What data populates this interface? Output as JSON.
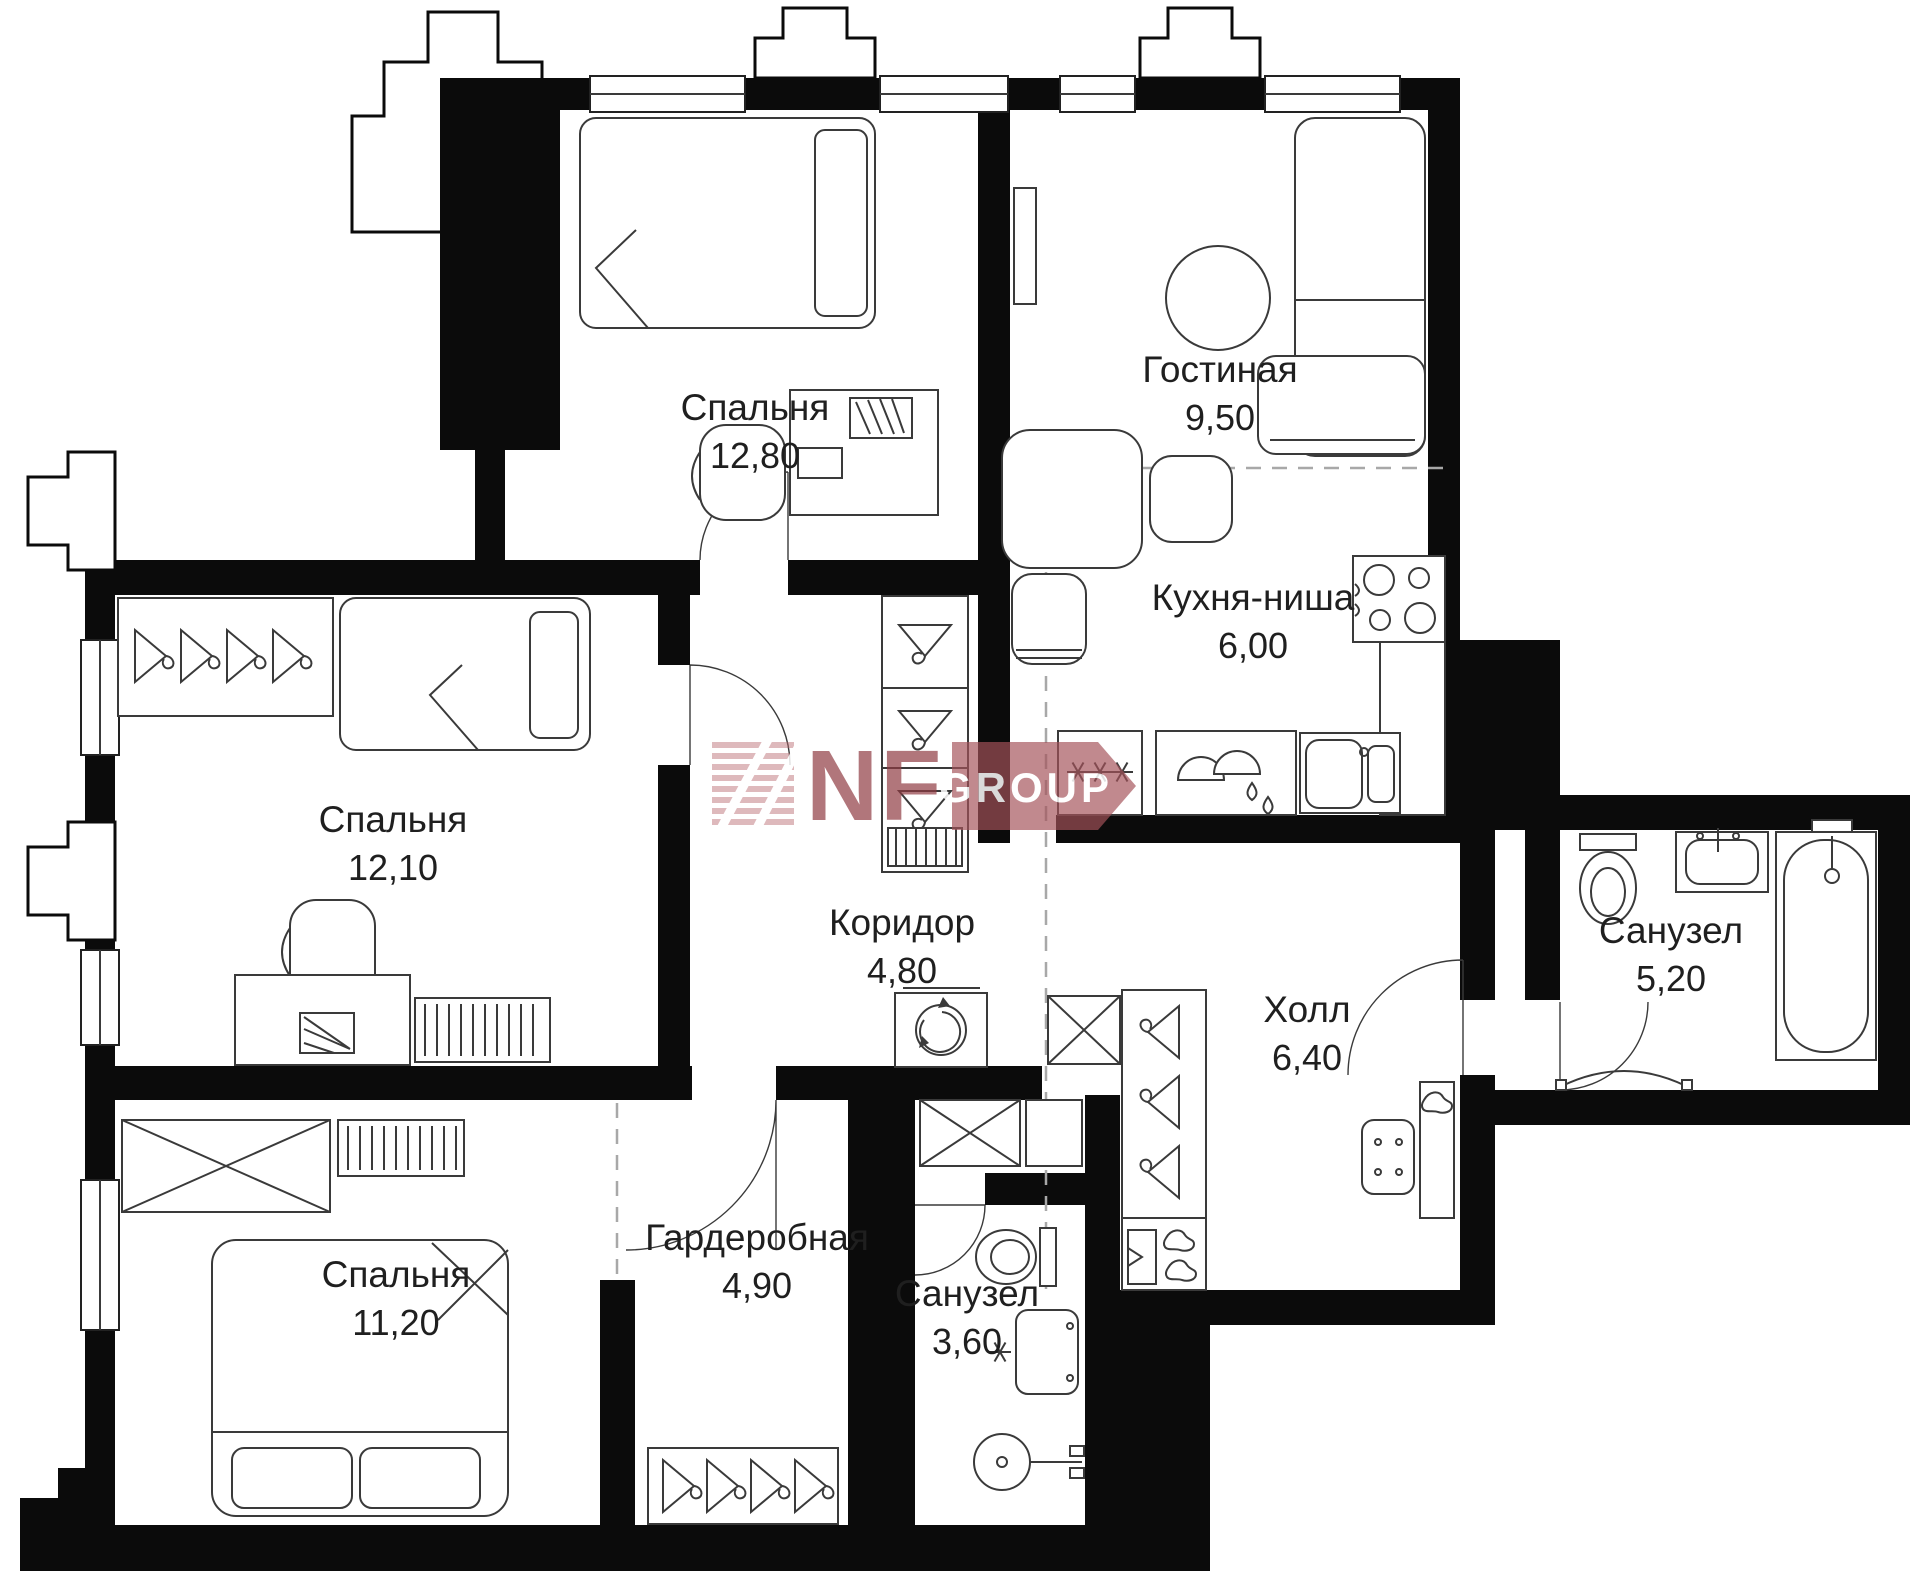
{
  "plan": {
    "type": "apartment-floor-plan",
    "rooms": [
      {
        "id": "bedroom-1",
        "name": "Спальня",
        "area": "12,80"
      },
      {
        "id": "living",
        "name": "Гостиная",
        "area": "9,50"
      },
      {
        "id": "kitchen",
        "name": "Кухня-ниша",
        "area": "6,00"
      },
      {
        "id": "bedroom-2",
        "name": "Спальня",
        "area": "12,10"
      },
      {
        "id": "corridor",
        "name": "Коридор",
        "area": "4,80"
      },
      {
        "id": "hall",
        "name": "Холл",
        "area": "6,40"
      },
      {
        "id": "bathroom-1",
        "name": "Санузел",
        "area": "5,20"
      },
      {
        "id": "bedroom-3",
        "name": "Спальня",
        "area": "11,20"
      },
      {
        "id": "wardrobe",
        "name": "Гардеробная",
        "area": "4,90"
      },
      {
        "id": "bathroom-2",
        "name": "Санузел",
        "area": "3,60"
      }
    ],
    "watermark": {
      "brand": "NF",
      "suffix": "GROUP"
    },
    "colors": {
      "walls": "#0b0b0b",
      "lines": "#3a3a3a",
      "labels": "#1f1f1f",
      "zone_dashed": "#a8a8a8",
      "watermark_red": "#8f3a42",
      "watermark_band": "#a4525a",
      "watermark_stripe": "#c98f94",
      "background": "#ffffff"
    }
  }
}
